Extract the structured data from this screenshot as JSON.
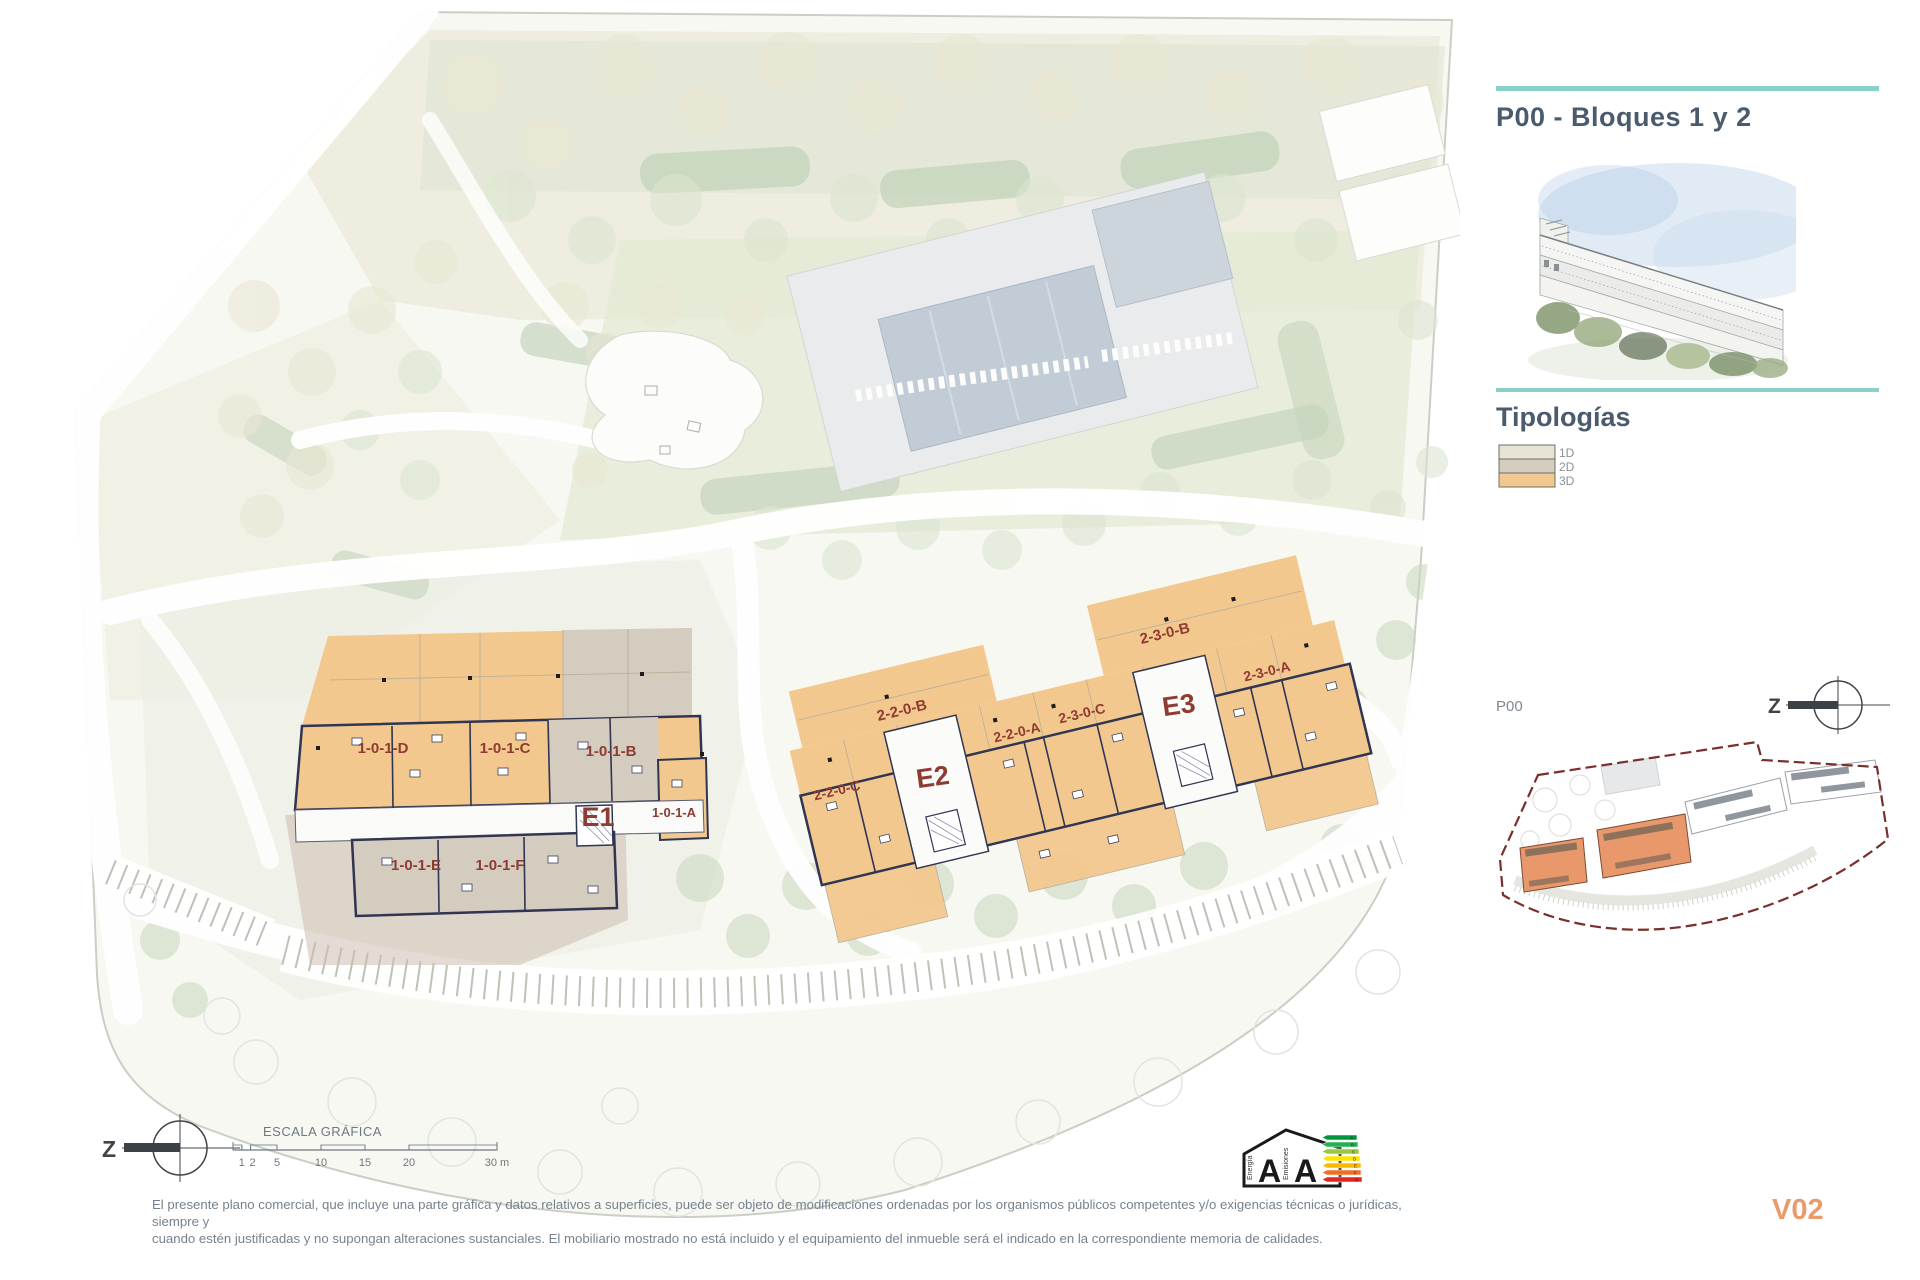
{
  "header": {
    "title": "P00 - Bloques 1 y 2"
  },
  "typologies": {
    "heading": "Tipologías",
    "items": [
      {
        "label": "1D",
        "color": "#e7e4d3"
      },
      {
        "label": "2D",
        "color": "#d5ccc0"
      },
      {
        "label": "3D",
        "color": "#f3c88e"
      }
    ]
  },
  "key_plan": {
    "label": "P00"
  },
  "compass": {
    "label": "Z"
  },
  "plan": {
    "unit_labels": [
      "1-0-1-D",
      "1-0-1-C",
      "1-0-1-B",
      "1-0-1-A",
      "1-0-1-E",
      "1-0-1-F",
      "2-2-0-C",
      "2-2-0-B",
      "2-2-0-A",
      "2-3-0-C",
      "2-3-0-B",
      "2-3-0-A"
    ],
    "core_labels": [
      "E1",
      "E2",
      "E3"
    ]
  },
  "scale_bar": {
    "title": "ESCALA GRÁFICA",
    "ticks": [
      "1",
      "2",
      "5",
      "10",
      "15",
      "20",
      "30 m"
    ]
  },
  "energy_label": {
    "letters": [
      "A",
      "A"
    ],
    "left_caption": "Energía",
    "right_caption": "Emisiones",
    "scale_letters": [
      "A",
      "B",
      "C",
      "D",
      "E",
      "F",
      "G"
    ],
    "colors": [
      "#00963f",
      "#21b24b",
      "#99ca3c",
      "#ffe200",
      "#fbb900",
      "#f06e22",
      "#e52321"
    ]
  },
  "footer": {
    "disclaimer_line1": "El presente plano comercial, que incluye una parte gráfica y datos relativos a superficies, puede ser objeto de modificaciones ordenadas por los organismos públicos competentes y/o exigencias técnicas o jurídicas, siempre y",
    "disclaimer_line2": "cuando estén justificadas y no supongan alteraciones sustanciales. El mobiliario mostrado no está incluido y el equipamiento del inmueble será el indicado en la correspondiente memoria de calidades.",
    "version": "V02"
  },
  "colors": {
    "accent_teal": "#89d0c9",
    "label_red": "#8e3c31",
    "walls": "#2f3552",
    "keyplan_highlight": "#e8986a"
  }
}
